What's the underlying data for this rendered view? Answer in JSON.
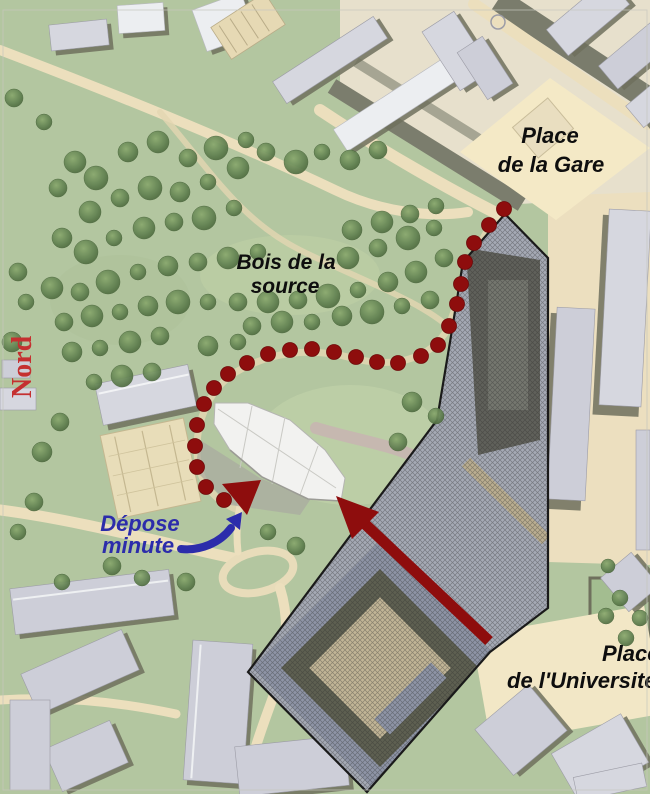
{
  "map": {
    "title": "Site plan with pedestrian route from the station",
    "labels": {
      "place_de_la_gare": {
        "line1": "Place",
        "line2": "de la Gare"
      },
      "bois_de_la_source": {
        "line1": "Bois de la",
        "line2": "source"
      },
      "nord": "Nord",
      "depose_minute": {
        "line1": "Dépose",
        "line2": "minute"
      },
      "place_de_l_universite": {
        "line1": "Place",
        "line2": "de l'Université"
      }
    },
    "colors": {
      "park_green": "#b3c6a0",
      "woods_tree": "#5d7f4b",
      "path_cream": "#ecdfbd",
      "plaza_cream": "#f4e9c6",
      "building_light": "#d6d7df",
      "building_shadow": "#6f705d",
      "site_hatch_base": "#b2b7c3",
      "site_outline": "#1a1a1a",
      "route_red": "#8e0d0d",
      "arrow_red": "#8e0d0d",
      "depose_blue": "#2c2cab",
      "nord_red": "#c53030",
      "label_black": "#0e0e0e"
    },
    "route": {
      "description": "dotted pedestrian route from Place de la Gare through Bois de la source to the new building",
      "dot_radius": 7.5,
      "dots": [
        [
          504,
          209
        ],
        [
          489,
          225
        ],
        [
          474,
          243
        ],
        [
          465,
          262
        ],
        [
          461,
          284
        ],
        [
          457,
          304
        ],
        [
          449,
          326
        ],
        [
          438,
          345
        ],
        [
          421,
          356
        ],
        [
          398,
          363
        ],
        [
          377,
          362
        ],
        [
          356,
          357
        ],
        [
          334,
          352
        ],
        [
          312,
          349
        ],
        [
          290,
          350
        ],
        [
          268,
          354
        ],
        [
          247,
          363
        ],
        [
          228,
          374
        ],
        [
          214,
          388
        ],
        [
          204,
          404
        ],
        [
          197,
          425
        ],
        [
          195,
          446
        ],
        [
          197,
          467
        ],
        [
          206,
          487
        ],
        [
          224,
          500
        ]
      ]
    }
  }
}
